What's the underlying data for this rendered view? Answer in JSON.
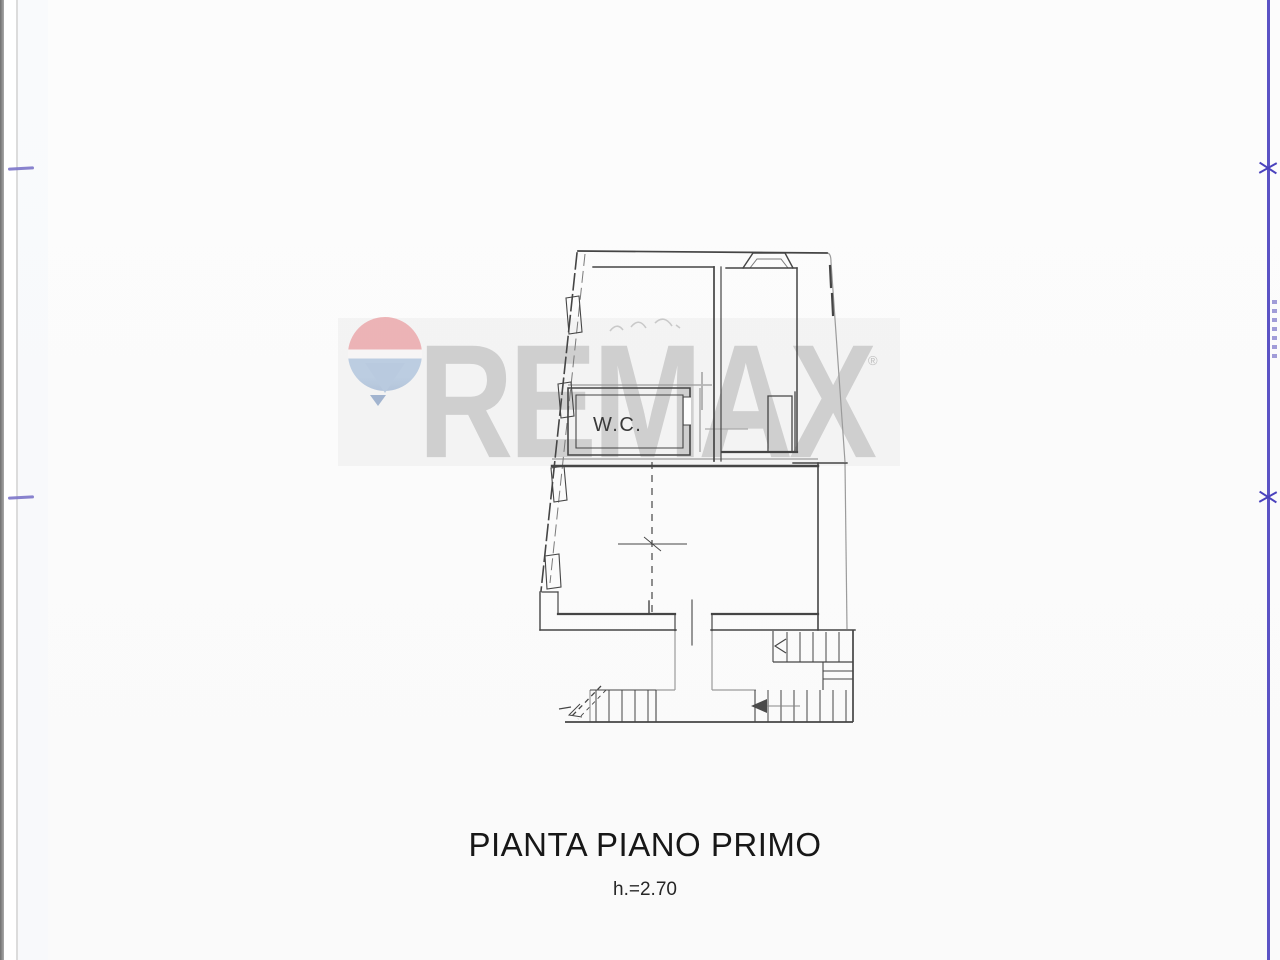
{
  "document": {
    "title": "PIANTA PIANO PRIMO",
    "subtitle": "h.=2.70"
  },
  "floor_plan": {
    "room_label_wc": "W.C."
  },
  "watermark": {
    "brand_text": "REMAX",
    "registered_symbol": "®",
    "colors": {
      "letters": "#cccccc",
      "band": "#efefef",
      "balloon_red": "#eba9ac",
      "balloon_white": "#f8f6f6",
      "balloon_blue": "#b3c7de",
      "balloon_basket": "#94aac9"
    }
  },
  "frame": {
    "right_plot_line_color": "#5b53c5",
    "tick_color": "#7b74c9",
    "drawing_ink_color": "#454545"
  }
}
